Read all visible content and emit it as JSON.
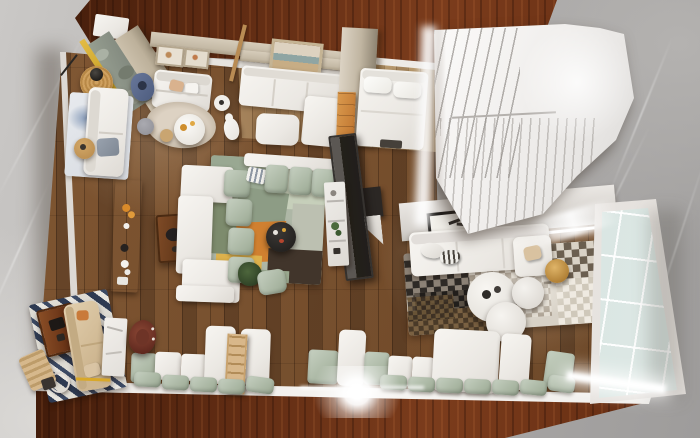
{
  "scene": {
    "type": "3d-interior-render",
    "view": "top-down dollhouse view",
    "description": "Overhead render of an open-plan apartment scale model standing on a mahogany table over gray marble flooring",
    "visible_text": "none"
  },
  "palette": {
    "marble_light": "#cac8c6",
    "marble_dark": "#9e9c9b",
    "table_mahogany": "#5d2a12",
    "floor_walnut": "#6e4a2c",
    "floor_light_oak": "#b2946a",
    "wall_white": "#ebe8e3",
    "wall_beige": "#c4b9a5",
    "sofa_white": "#f4f2ee",
    "cushion_sage": "#a7b4a0",
    "rug_orange": "#d08030",
    "rug_mustard": "#ddb14c",
    "rug_dark_brown": "#41352b",
    "rug_patch_black": "#2e2a26",
    "console_walnut": "#5a3418",
    "cabinet_oak": "#c87f3a",
    "leather_brown": "#6b3026",
    "stripe_navy": "#2e3a52",
    "glass_pane": "#d3e2de",
    "gold_trim": "#c9a227",
    "stool_gold": "#c9973e",
    "led_light": "#ffffff"
  },
  "inventory": {
    "surroundings": [
      "marble-floor",
      "mahogany-table-top",
      "mahogany-table-bottom"
    ],
    "rooms": [
      {
        "name": "entry-lounge",
        "items": [
          "entry-door",
          "gold-marble-column",
          "gallery-wall-frames",
          "loveseat",
          "round-coffee-table",
          "rabbit-sculpture",
          "denim-pouf",
          "rattan-lamp-table",
          "beige-round-rug"
        ]
      },
      {
        "name": "left-nook",
        "items": [
          "cream-sofa",
          "watercolor-rug",
          "wood-side-tables",
          "gray-pouf"
        ]
      },
      {
        "name": "guest-room",
        "items": [
          "seascape-frame",
          "white-sectional",
          "white-ottoman",
          "wood-ladder",
          "oak-cabinet"
        ]
      },
      {
        "name": "bedroom",
        "items": [
          "double-bed",
          "pillows",
          "daylight-gap"
        ]
      },
      {
        "name": "staircase",
        "items": [
          "stair-flight-upper",
          "stair-landing",
          "slatted-stair-wall"
        ]
      },
      {
        "name": "living-room",
        "items": [
          "walnut-console",
          "square-coffee-table",
          "c-shaped-sofa",
          "sage-cushions",
          "patchwork-rug",
          "black-round-table",
          "potted-plant",
          "sage-pouf",
          "tv-panel",
          "white-etagere"
        ]
      },
      {
        "name": "second-lounge",
        "items": [
          "leaning-art-frame",
          "white-sofa",
          "striped-pillow",
          "gold-stool",
          "monochrome-patch-rug",
          "nesting-round-tables",
          "led-wall-strip",
          "glass-curtain-wall"
        ]
      },
      {
        "name": "window-bench",
        "items": [
          "bench-back-panels",
          "sage-bench-cushions",
          "blanket-ladder",
          "white-slab-table",
          "lens-flare"
        ]
      },
      {
        "name": "reading-corner",
        "items": [
          "striped-navy-rug",
          "tan-sofa",
          "walnut-table",
          "leather-armchair",
          "marble-console",
          "ring-mirror",
          "folded-deck-chair"
        ]
      }
    ]
  }
}
